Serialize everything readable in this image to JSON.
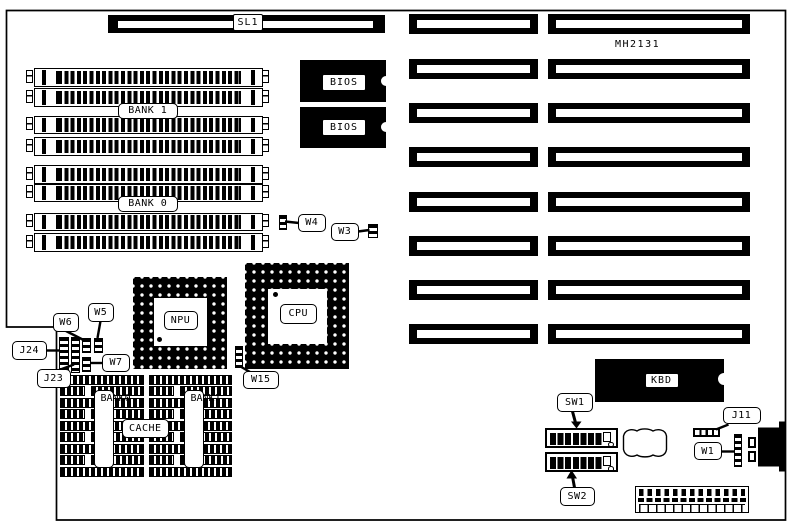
{
  "diagram": {
    "model": "MH2131",
    "colors": {
      "line": "#000000",
      "background": "#ffffff"
    },
    "labels": {
      "sl1": "SL1",
      "bank1": "BANK 1",
      "bank0": "BANK 0",
      "bios1": "BIOS",
      "bios2": "BIOS",
      "npu": "NPU",
      "cpu": "CPU",
      "cache": "CACHE",
      "cache_bank0": "BANK0",
      "cache_bank1": "BANK1",
      "kbd": "KBD",
      "sw1": "SW1",
      "sw2": "SW2",
      "j11": "J11",
      "j24": "J24",
      "j23": "J23",
      "w1": "W1",
      "w3": "W3",
      "w4": "W4",
      "w5": "W5",
      "w6": "W6",
      "w7": "W7",
      "w15": "W15"
    },
    "counts": {
      "simm_sockets": 8,
      "expansion_slots": 8,
      "bios_chips": 2,
      "dip_switches": 2,
      "dip_positions_per_switch": 8,
      "cache_bank_columns": 2
    }
  }
}
